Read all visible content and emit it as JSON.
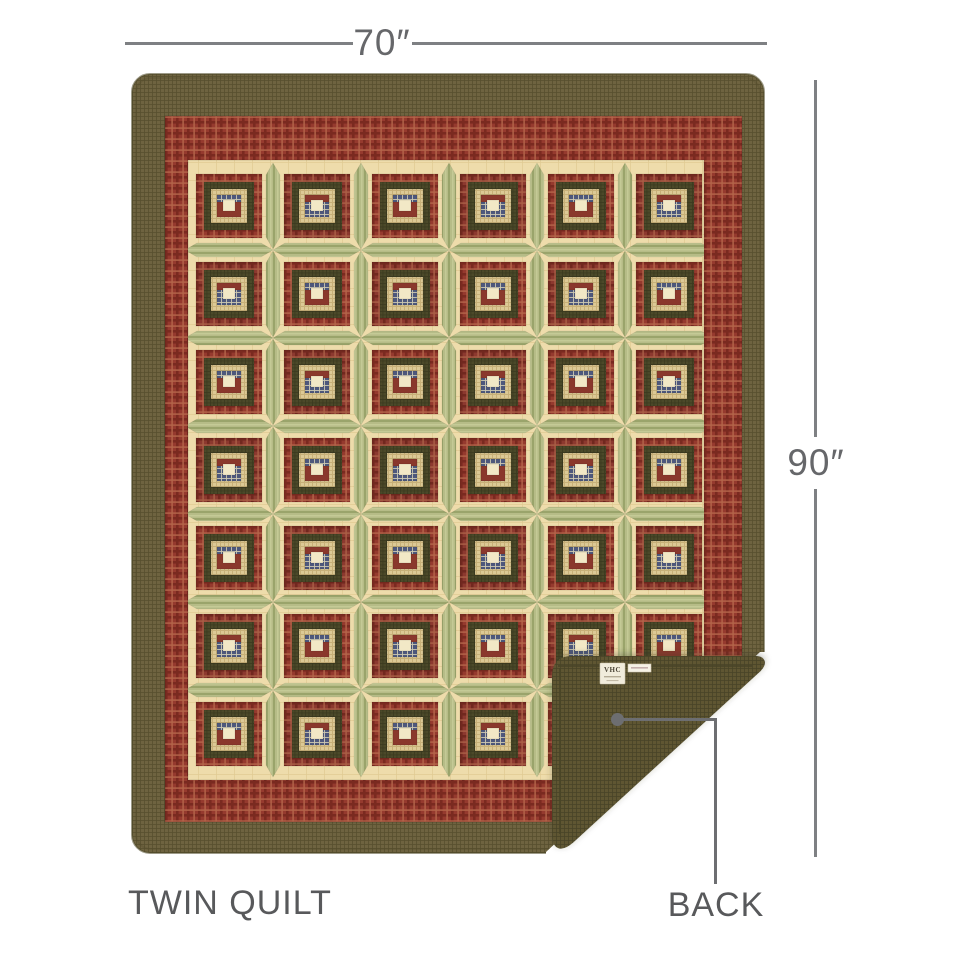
{
  "product_diagram": {
    "width_label": "70″",
    "height_label": "90″",
    "size_label": "TWIN QUILT",
    "back_label": "BACK",
    "tag_brand": "VHC",
    "annotation_line_color": "#7e8083",
    "annotation_text_color": "#58595b",
    "callout_color": "#6d6e71"
  },
  "quilt": {
    "grid": {
      "columns": 6,
      "rows": 7
    },
    "palette": {
      "border_olive": "#6e6340",
      "border_olive_line": "#584f2e",
      "back_olive": "#5e5732",
      "back_olive_line": "#4a4428",
      "red_plaid": "#953a2e",
      "red_plaid_dark": "#7a2a20",
      "red_plaid_light": "#b4654a",
      "red_plaid_alt": "#8c392f",
      "red_plaid_alt_dark": "#71281f",
      "red_plaid_alt_light": "#aa5f46",
      "red_log_inner": "#8a382c",
      "field_tan": "#eedcab",
      "field_tan_line": "#e0cb92",
      "green_sash": "#b6bc87",
      "green_sash_line": "#9aa46b",
      "green_sash_light": "#c8cd9a",
      "dark_olive_log": "#4b4929",
      "dark_olive_log_line": "#3b3a1f",
      "tan_check": "#dcc995",
      "tan_check_line": "#c7b078",
      "navy_plaid": "#4e587c",
      "navy_plaid_line": "#ccc8b2",
      "center_cream": "#f2e8c6",
      "binding": "#4f4828",
      "tag_paper": "#f1ecdc",
      "tag_text": "#4a4436",
      "shadow": "#3c3a2e"
    }
  }
}
